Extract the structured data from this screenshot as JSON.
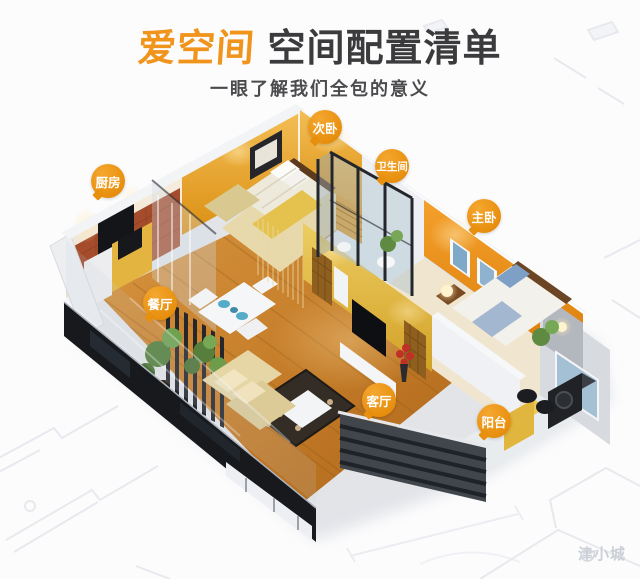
{
  "header": {
    "brand": "爱空间",
    "title": "空间配置清单",
    "subtitle": "一眼了解我们全包的意义"
  },
  "rooms": [
    {
      "label": "厨房",
      "x": 108,
      "y": 181
    },
    {
      "label": "次卧",
      "x": 325,
      "y": 127
    },
    {
      "label": "卫生间",
      "x": 392,
      "y": 166
    },
    {
      "label": "主卧",
      "x": 484,
      "y": 216
    },
    {
      "label": "餐厅",
      "x": 160,
      "y": 303
    },
    {
      "label": "客厅",
      "x": 379,
      "y": 400
    },
    {
      "label": "阳台",
      "x": 494,
      "y": 421
    }
  ],
  "watermark": {
    "text": "津小城",
    "icon": "mascot-face-icon"
  },
  "palette": {
    "accent_orange": "#F0941C",
    "badge_orange": "#E88F0E",
    "title_dark": "#3B3B3D",
    "subtitle_gray": "#4B4B4E",
    "orange_wall": "#E8880F",
    "yellow_wall": "#E5B23A",
    "wood_floor": "#C9802E",
    "watermark_gray": "#CBCFD6"
  }
}
